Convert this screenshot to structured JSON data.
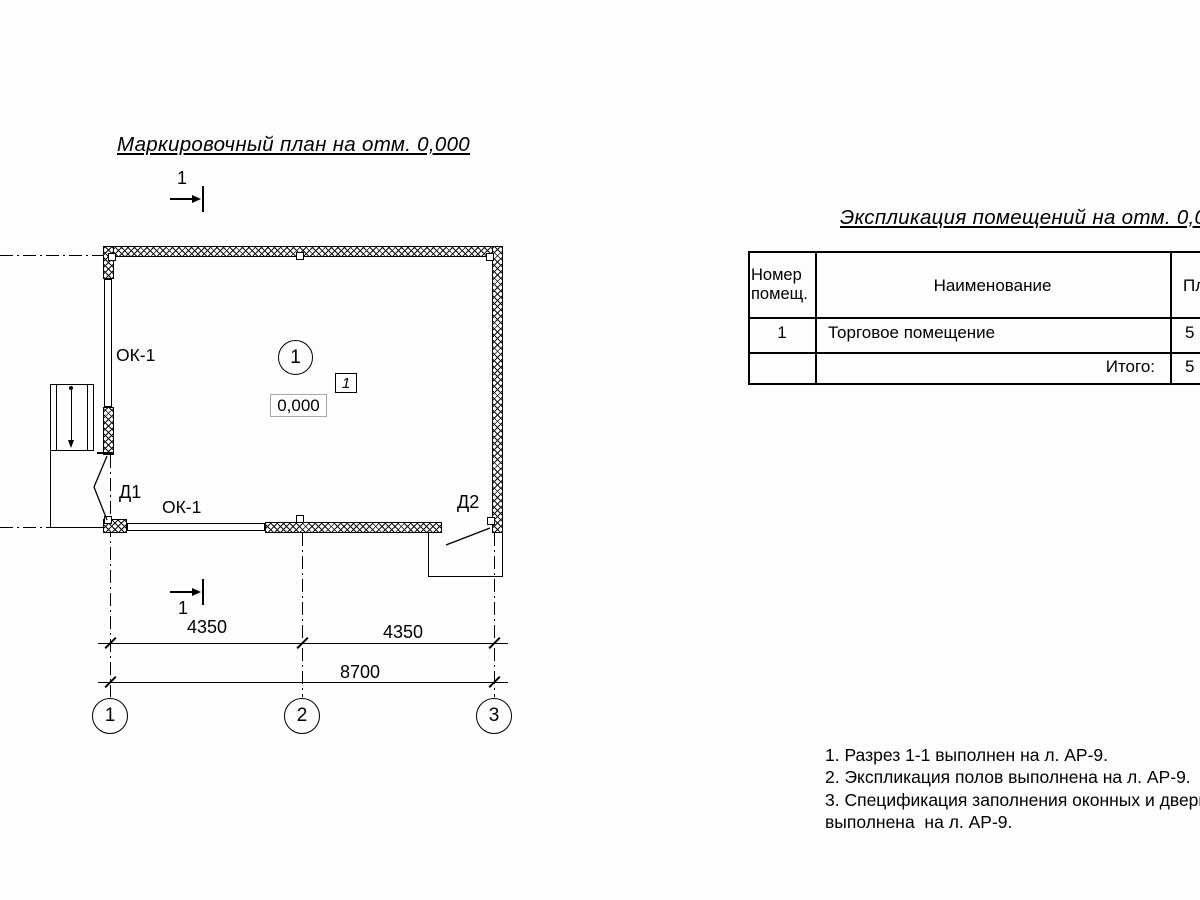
{
  "colors": {
    "ink": "#000000",
    "paper": "#fdfdfd",
    "elevation_box_border": "#a8a8a8"
  },
  "plan": {
    "title": "Маркировочный план на отм. 0,000",
    "section_cut": {
      "label_top": "1",
      "label_bottom": "1"
    },
    "room_number_circle": "1",
    "room_box_tag": "1",
    "elevation_mark": "0,000",
    "window_left_label": "ОК-1",
    "window_bottom_label": "ОК-1",
    "door1_label": "Д1",
    "door2_label": "Д2",
    "dimensions": {
      "span_1_2": "4350",
      "span_2_3": "4350",
      "total": "8700"
    },
    "axes": [
      "1",
      "2",
      "3"
    ]
  },
  "explication": {
    "title": "Экспликация помещений на отм. 0,000",
    "col_room_number": "Номер помещ.",
    "col_name": "Наименование",
    "col_area": "Площадь, м²",
    "rows": [
      {
        "number": "1",
        "name": "Торговое помещение",
        "area": "5"
      }
    ],
    "total_label": "Итого:",
    "total_area": "5"
  },
  "notes": {
    "lines": [
      "1. Разрез 1-1 выполнен на л. АР-9.",
      "2. Экспликация полов выполнена на л. АР-9.",
      "3. Спецификация заполнения оконных и дверных",
      "выполнена  на л. АР-9."
    ]
  }
}
